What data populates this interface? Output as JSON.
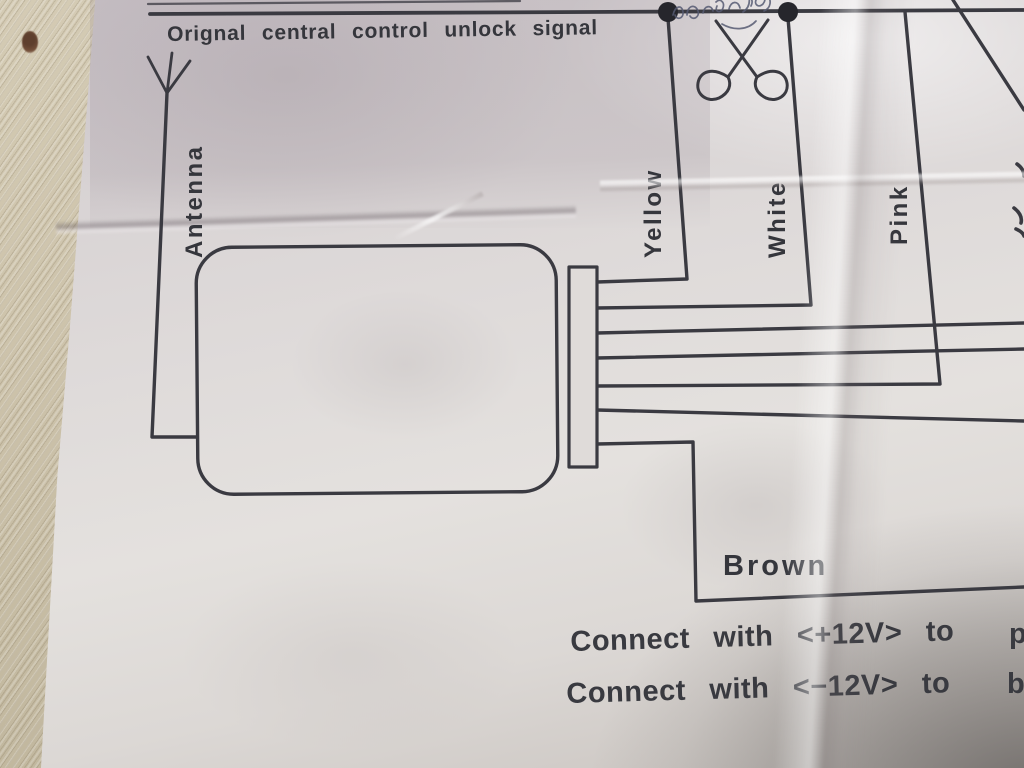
{
  "labels": {
    "top_signal": "Orignal central control unlock signal",
    "antenna": "Antenna",
    "yellow": "Yellow",
    "white": "White",
    "pink": "Pink",
    "brown": "Brown"
  },
  "instructions": {
    "line1": "Connect with <+12V> to",
    "line1_fragment": "p",
    "line2": "Connect with <−12V> to",
    "line2_fragment": "b"
  },
  "icons": {
    "antenna": "antenna-icon",
    "scissors": "scissors-cut-icon",
    "junction_dot_count": 2,
    "handwriting": "pen-scribble"
  },
  "colors": {
    "ink": "#3a3a41",
    "pen_ink": "#565a72",
    "paper": "#dcd7d5",
    "fabric": "#c9c0a9",
    "stain": "#5e3f2d"
  }
}
